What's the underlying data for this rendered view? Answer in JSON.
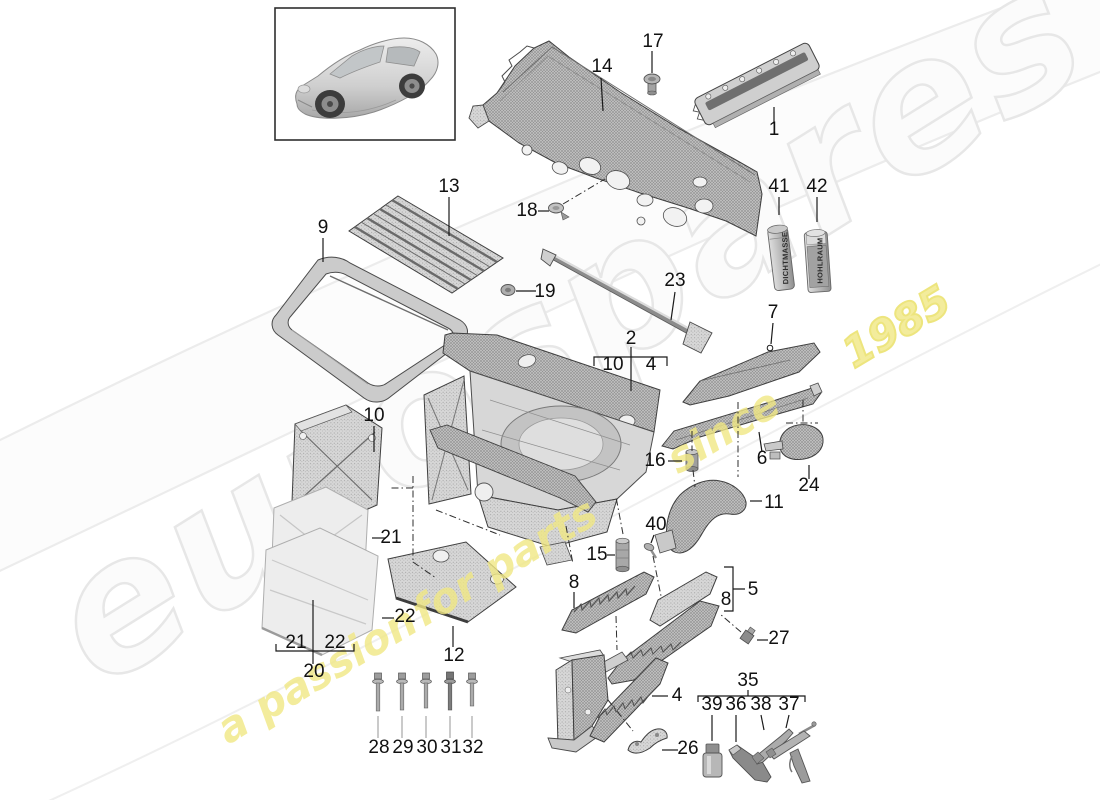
{
  "diagram": {
    "kind": "exploded-parts-diagram",
    "subject": "front end body panels"
  },
  "watermark": {
    "brand": "eurospares",
    "tagline": "a passion for parts since 1985",
    "tagline_parts": {
      "p1": "a passion",
      "p2": "for parts",
      "p3": "since",
      "p4": "1985"
    },
    "brand_color": "#e7e7e7",
    "tagline_color": "#f1e884"
  },
  "consumables": [
    {
      "callout": "41",
      "label": "DICHTMASSE"
    },
    {
      "callout": "42",
      "label": "HOHLRAUM"
    }
  ],
  "callouts": [
    {
      "id": "1",
      "label": "1",
      "x": 774,
      "y": 135
    },
    {
      "id": "2",
      "label": "2",
      "x": 631,
      "y": 344
    },
    {
      "id": "4-bracket",
      "label": "4",
      "x": 651,
      "y": 370
    },
    {
      "id": "4-bottom",
      "label": "4",
      "x": 677,
      "y": 701
    },
    {
      "id": "5",
      "label": "5",
      "x": 753,
      "y": 595
    },
    {
      "id": "6",
      "label": "6",
      "x": 762,
      "y": 464
    },
    {
      "id": "7",
      "label": "7",
      "x": 773,
      "y": 318
    },
    {
      "id": "8-left",
      "label": "8",
      "x": 574,
      "y": 588
    },
    {
      "id": "8-bracket",
      "label": "8",
      "x": 726,
      "y": 605
    },
    {
      "id": "9",
      "label": "9",
      "x": 323,
      "y": 233
    },
    {
      "id": "10-bracket",
      "label": "10",
      "x": 613,
      "y": 370
    },
    {
      "id": "10-left",
      "label": "10",
      "x": 374,
      "y": 421
    },
    {
      "id": "11",
      "label": "11",
      "x": 774,
      "y": 508
    },
    {
      "id": "12",
      "label": "12",
      "x": 454,
      "y": 661
    },
    {
      "id": "13",
      "label": "13",
      "x": 449,
      "y": 192
    },
    {
      "id": "14",
      "label": "14",
      "x": 602,
      "y": 72
    },
    {
      "id": "15",
      "label": "15",
      "x": 597,
      "y": 560
    },
    {
      "id": "16",
      "label": "16",
      "x": 655,
      "y": 466
    },
    {
      "id": "17",
      "label": "17",
      "x": 653,
      "y": 47
    },
    {
      "id": "18",
      "label": "18",
      "x": 527,
      "y": 216
    },
    {
      "id": "19",
      "label": "19",
      "x": 545,
      "y": 297
    },
    {
      "id": "20",
      "label": "20",
      "x": 314,
      "y": 677
    },
    {
      "id": "21-mid",
      "label": "21",
      "x": 391,
      "y": 543
    },
    {
      "id": "21-bracket",
      "label": "21",
      "x": 296,
      "y": 648
    },
    {
      "id": "22-mid",
      "label": "22",
      "x": 405,
      "y": 622
    },
    {
      "id": "22-bracket",
      "label": "22",
      "x": 335,
      "y": 648
    },
    {
      "id": "23",
      "label": "23",
      "x": 675,
      "y": 286
    },
    {
      "id": "24",
      "label": "24",
      "x": 809,
      "y": 491
    },
    {
      "id": "26",
      "label": "26",
      "x": 688,
      "y": 754
    },
    {
      "id": "27",
      "label": "27",
      "x": 779,
      "y": 644
    },
    {
      "id": "28",
      "label": "28",
      "x": 379,
      "y": 753
    },
    {
      "id": "29",
      "label": "29",
      "x": 403,
      "y": 753
    },
    {
      "id": "30",
      "label": "30",
      "x": 427,
      "y": 753
    },
    {
      "id": "31",
      "label": "31",
      "x": 451,
      "y": 753
    },
    {
      "id": "32",
      "label": "32",
      "x": 473,
      "y": 753
    },
    {
      "id": "35",
      "label": "35",
      "x": 748,
      "y": 686
    },
    {
      "id": "36",
      "label": "36",
      "x": 736,
      "y": 710
    },
    {
      "id": "37",
      "label": "37",
      "x": 789,
      "y": 710
    },
    {
      "id": "38",
      "label": "38",
      "x": 761,
      "y": 710
    },
    {
      "id": "39",
      "label": "39",
      "x": 712,
      "y": 710
    },
    {
      "id": "40",
      "label": "40",
      "x": 656,
      "y": 530
    },
    {
      "id": "41",
      "label": "41",
      "x": 779,
      "y": 192
    },
    {
      "id": "42",
      "label": "42",
      "x": 817,
      "y": 192
    }
  ]
}
